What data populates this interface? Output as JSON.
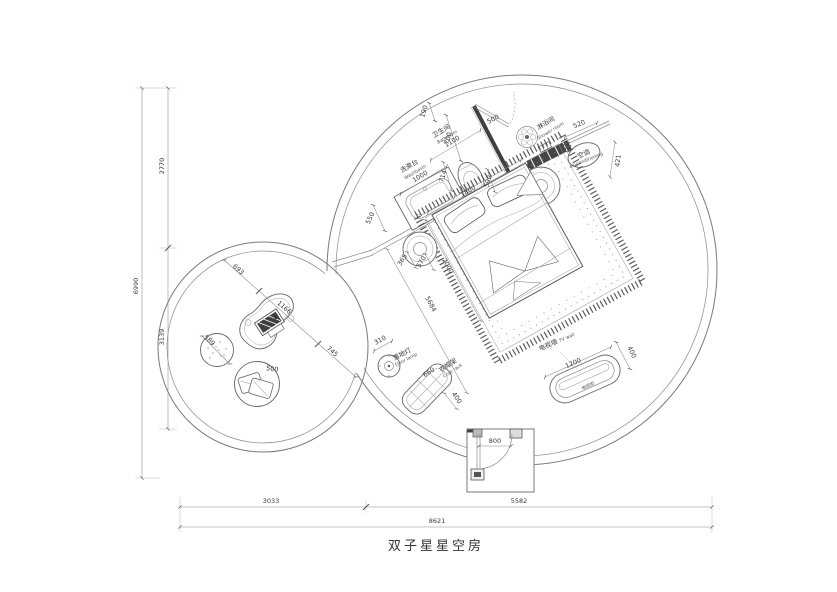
{
  "title": "双子星星空房",
  "labels": {
    "washbasin_zh": "洗漱台",
    "washbasin_en": "Washbasin",
    "bathroom_zh": "卫生间",
    "bathroom_en": "Bathroom",
    "shower_zh": "淋浴间",
    "shower_en": "Shower room",
    "ac_zh": "空调",
    "ac_en": "air-conditioning",
    "tv_wall_zh": "电视墙",
    "tv_wall_en": "TV wall",
    "tv_cabinet_zh": "电视柜",
    "lamp_zh": "落地灯",
    "lamp_en": "Floor lamp",
    "coat_zh": "衣帽架",
    "coat_en": "Coat rack"
  },
  "dims": {
    "washbasin": "1000",
    "bathroom": "1100",
    "top_offset": "190",
    "bath_wall": "700",
    "bath_door": "500",
    "toilet_clear": "590",
    "toilet_front": "714",
    "head_wall": "1800",
    "basin_side": "550",
    "shower_wall": "520",
    "ac_depth": "421",
    "bed_length": "2000",
    "room_diag": "5684",
    "stool_a": "365",
    "stool_b": "570",
    "lamp": "310",
    "coat_len": "660",
    "coat_dep": "400",
    "tv_len": "1200",
    "tv_dep": "400",
    "entry": "800",
    "lounge_a": "693",
    "lounge_b": "1166",
    "lounge_c": "745",
    "pouf": "589",
    "cushion": "500",
    "left_total": "6990",
    "left_upper": "2770",
    "left_lower": "3139",
    "bottom_left": "3033",
    "bottom_right": "5582",
    "bottom_total": "8621"
  }
}
